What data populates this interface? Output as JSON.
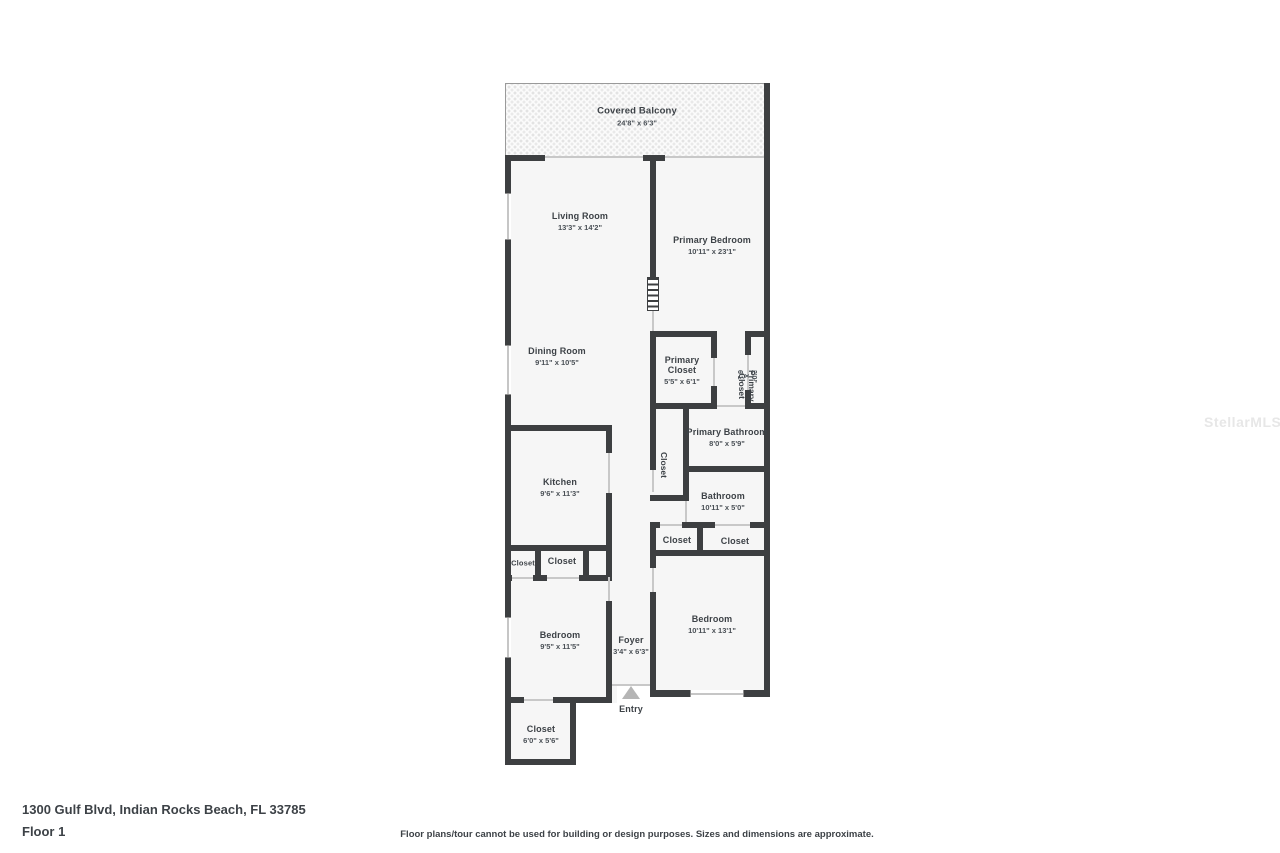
{
  "watermark": {
    "text": "StellarMLS"
  },
  "footer": {
    "address": "1300 Gulf Blvd, Indian Rocks Beach, FL 33785",
    "floor": "Floor 1",
    "disclaimer": "Floor plans/tour cannot be used for building or design purposes. Sizes and dimensions are approximate."
  },
  "entry": {
    "label": "Entry"
  },
  "rooms": {
    "balcony": {
      "name": "Covered Balcony",
      "dims": "24'8\" x 6'3\""
    },
    "living": {
      "name": "Living Room",
      "dims": "13'3\" x 14'2\""
    },
    "primary_bedroom": {
      "name": "Primary Bedroom",
      "dims": "10'11\" x 23'1\""
    },
    "dining": {
      "name": "Dining Room",
      "dims": "9'11\" x 10'5\""
    },
    "primary_closet": {
      "name": "Primary Closet",
      "dims": "5'5\" x 6'1\""
    },
    "primary_closet_2": {
      "name": "Primary Closet",
      "dims": "2'0\" x 6'1\""
    },
    "primary_bathroom": {
      "name": "Primary Bathroom",
      "dims": "8'0\" x 5'9\""
    },
    "hall_closet": {
      "name": "Closet"
    },
    "bathroom": {
      "name": "Bathroom",
      "dims": "10'11\" x 5'0\""
    },
    "bath_closet_1": {
      "name": "Closet"
    },
    "bath_closet_2": {
      "name": "Closet"
    },
    "kitchen": {
      "name": "Kitchen",
      "dims": "9'6\" x 11'3\""
    },
    "kitchen_closet_1": {
      "name": "Closet"
    },
    "kitchen_closet_2": {
      "name": "Closet"
    },
    "bedroom_left": {
      "name": "Bedroom",
      "dims": "9'5\" x 11'5\""
    },
    "foyer": {
      "name": "Foyer",
      "dims": "3'4\" x 6'3\""
    },
    "bedroom_right": {
      "name": "Bedroom",
      "dims": "10'11\" x 13'1\""
    },
    "entry_closet": {
      "name": "Closet",
      "dims": "6'0\" x 5'6\""
    }
  }
}
